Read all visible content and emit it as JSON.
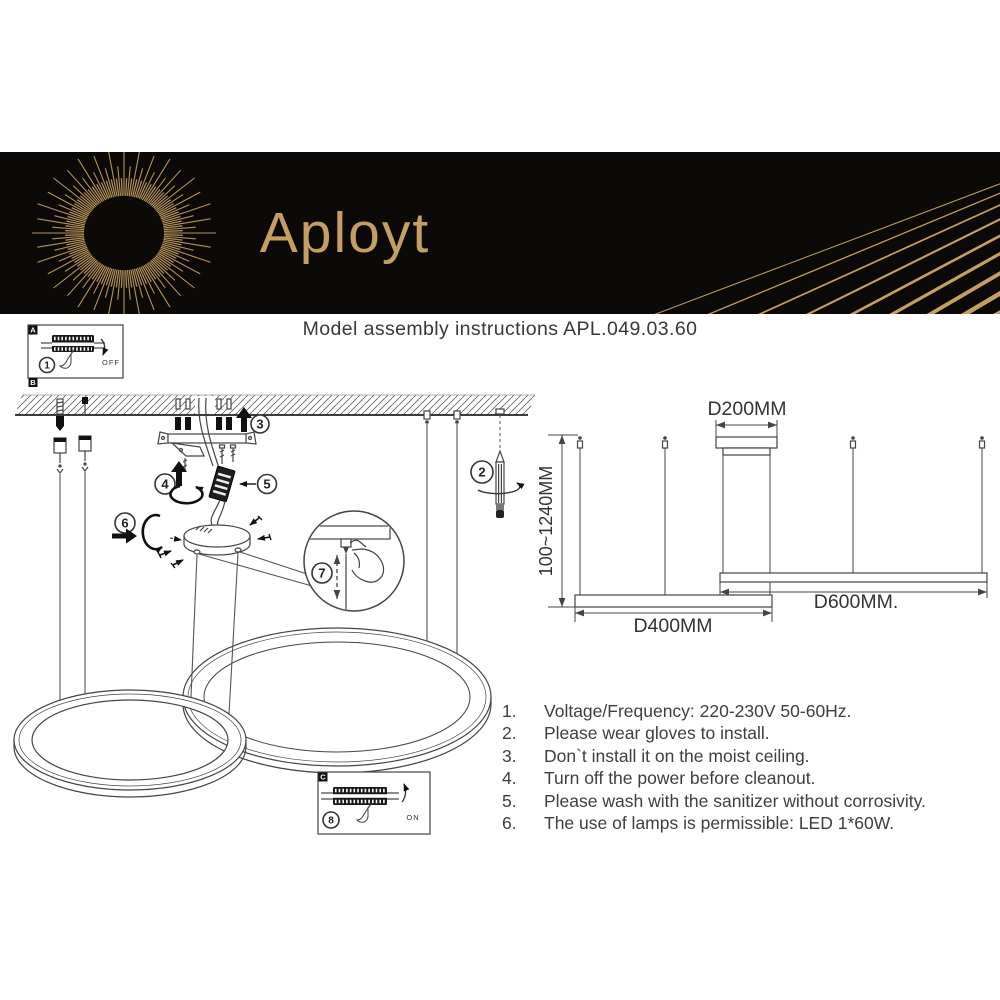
{
  "header": {
    "brand": "Aployt"
  },
  "title": "Model assembly instructions APL.049.03.60",
  "panels": {
    "a_label": "A",
    "b_label": "B",
    "c_label": "C",
    "off_label": "OFF",
    "on_label": "ON"
  },
  "steps": {
    "s1": "1",
    "s2": "2",
    "s3": "3",
    "s4": "4",
    "s5": "5",
    "s6": "6",
    "s7": "7",
    "s8": "8"
  },
  "dimensions": {
    "top_diameter": "D200MM",
    "middle_diameter": "D600MM.",
    "bottom_diameter": "D400MM",
    "hanging_height": "100~1240MM"
  },
  "instructions": {
    "items": [
      {
        "num": "1.",
        "text": "Voltage/Frequency: 220-230V 50-60Hz."
      },
      {
        "num": "2.",
        "text": "Please wear gloves to install."
      },
      {
        "num": "3.",
        "text": "Don`t install it on the moist ceiling."
      },
      {
        "num": "4.",
        "text": "Turn off the power before cleanout."
      },
      {
        "num": "5.",
        "text": "Please wash with the sanitizer without corrosivity."
      },
      {
        "num": "6.",
        "text": "The use of lamps is permissible: LED 1*60W."
      }
    ]
  },
  "colors": {
    "gold": "#c59e63",
    "header_bg": "#0b0a08",
    "line": "#444444"
  }
}
